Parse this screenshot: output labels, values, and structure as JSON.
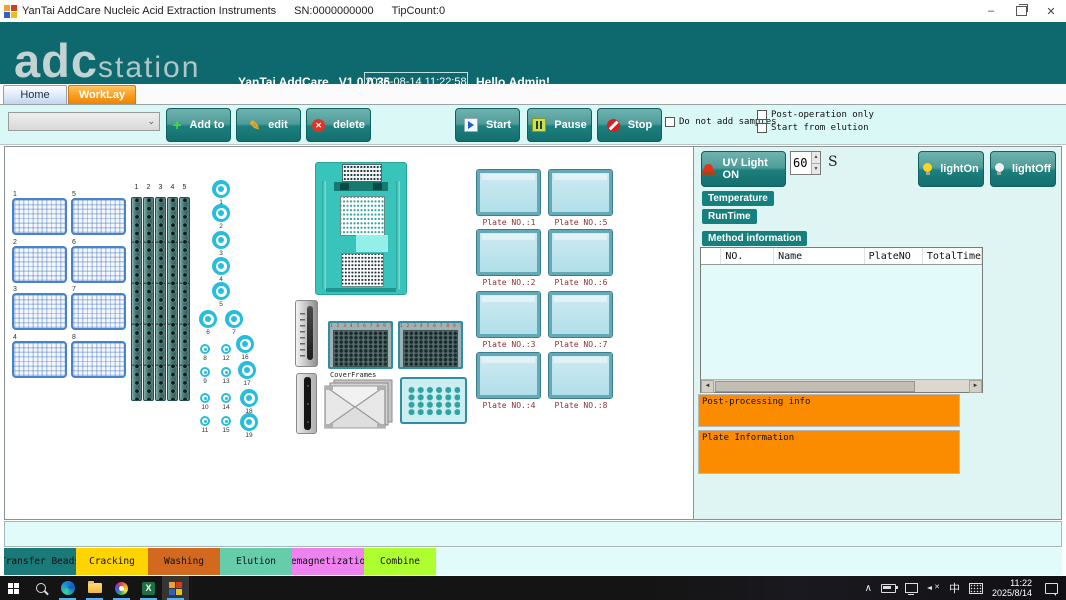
{
  "icons": {
    "minimize": "–",
    "close": "✕",
    "dropdown_chevron": "⌄",
    "plus": "+",
    "pencil": "✎",
    "delete_cross": "✕",
    "spin_up": "▲",
    "spin_down": "▼",
    "scroll_left": "◄",
    "scroll_right": "►",
    "tray_chevron": "∧",
    "excel_x": "X"
  },
  "titlebar": {
    "title": "YanTai AddCare Nucleic Acid Extraction Instruments",
    "sn": "SN:0000000000",
    "tip_count": "TipCount:0"
  },
  "header": {
    "logo_primary": "adc",
    "logo_secondary": "station",
    "brand": "YanTai AddCare",
    "version": "V1.0.0.36",
    "datetime": "2025-08-14 11:22:58",
    "greeting": "Hello,Admin!"
  },
  "tabs": {
    "home": "Home",
    "worklay": "WorkLay"
  },
  "toolbar": {
    "add_button": "Add to",
    "edit_button": "edit",
    "delete_button": "delete",
    "start_button": "Start",
    "pause_button": "Pause",
    "stop_button": "Stop",
    "do_not_add_samples": "Do not add samples",
    "post_operation_only": "Post-operation only",
    "start_from_elution": "Start from elution"
  },
  "deck": {
    "sample_plate_numbers": [
      "1",
      "2",
      "3",
      "4",
      "5",
      "6",
      "7",
      "8"
    ],
    "tip_rack_numbers": [
      "1",
      "2",
      "3",
      "4",
      "5"
    ],
    "position_numbers": [
      "1",
      "2",
      "3",
      "4",
      "5",
      "6",
      "7",
      "8",
      "9",
      "10",
      "11",
      "12",
      "13",
      "14",
      "15",
      "16",
      "17",
      "18",
      "19"
    ],
    "well_column_numbers": "1 2 3 4 5 6 7 8 9 10 11 12",
    "cover_frames_label": "CoverFrames",
    "plate_labels": [
      "Plate NO.:1",
      "Plate NO.:2",
      "Plate NO.:3",
      "Plate NO.:4",
      "Plate NO.:5",
      "Plate NO.:6",
      "Plate NO.:7",
      "Plate NO.:8"
    ]
  },
  "panel": {
    "uv_button": "UV Light ON",
    "uv_seconds": "60",
    "uv_unit": "S",
    "light_on_button": "lightOn",
    "light_off_button": "lightOff",
    "temperature_label": "Temperature",
    "runtime_label": "RunTime",
    "method_info_label": "Method information",
    "table_columns": [
      "NO.",
      "Name",
      "PlateNO",
      "TotalTime"
    ],
    "post_processing_label": "Post-processing info",
    "plate_information_label": "Plate Information"
  },
  "legend": {
    "items": [
      {
        "label": "Transfer Beads",
        "color": "#1a7a7a"
      },
      {
        "label": "Cracking",
        "color": "#ffd400"
      },
      {
        "label": "Washing",
        "color": "#d2691e"
      },
      {
        "label": "Elution",
        "color": "#66cdaa"
      },
      {
        "label": "Demagnetization",
        "color": "#ee82ee"
      },
      {
        "label": "Combine",
        "color": "#adff2f"
      }
    ]
  },
  "taskbar": {
    "time": "11:22",
    "date": "2025/8/14",
    "ime": "中"
  }
}
